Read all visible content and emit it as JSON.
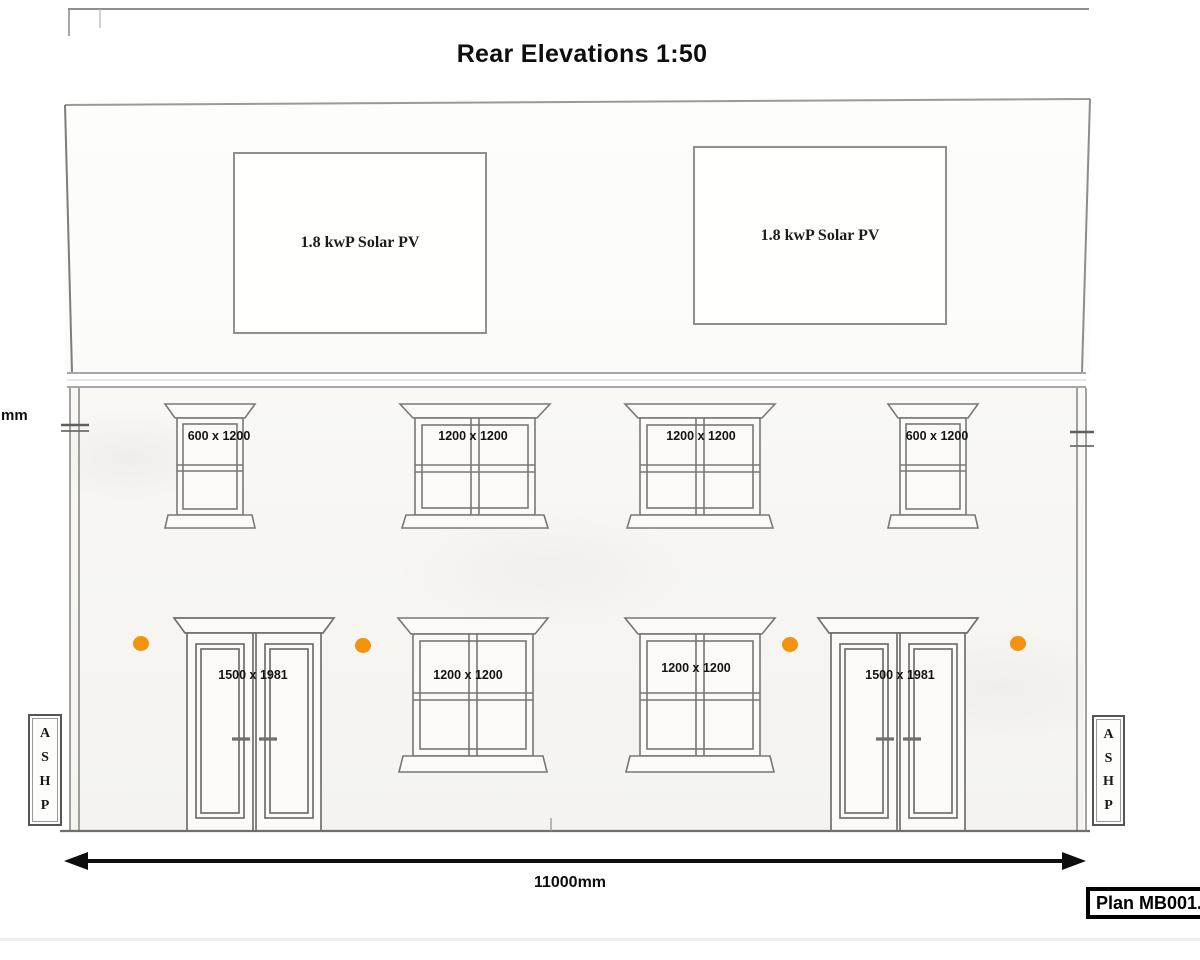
{
  "page": {
    "title": "Rear Elevations 1:50"
  },
  "roof": {
    "solar_panels": [
      {
        "label": "1.8 kwP Solar PV"
      },
      {
        "label": "1.8 kwP Solar PV"
      }
    ]
  },
  "upper_windows": [
    {
      "label": "600 x 1200"
    },
    {
      "label": "1200 x 1200"
    },
    {
      "label": "1200 x 1200"
    },
    {
      "label": "600 x 1200"
    }
  ],
  "ground_floor_openings": [
    {
      "type": "double_door",
      "label": "1500 x 1981"
    },
    {
      "type": "window",
      "label": "1200 x 1200"
    },
    {
      "type": "window",
      "label": "1200 x 1200"
    },
    {
      "type": "double_door",
      "label": "1500 x 1981"
    }
  ],
  "ashp_left": {
    "letters": [
      "A",
      "S",
      "H",
      "P"
    ]
  },
  "ashp_right": {
    "letters": [
      "A",
      "S",
      "H",
      "P"
    ]
  },
  "dimensions": {
    "overall_width": "11000mm",
    "left_edge_partial": "mm"
  },
  "plan_ref": {
    "label": "Plan MB001."
  },
  "colors": {
    "vent_dot": "#F5920D",
    "pencil": "#8b8b8b",
    "ink": "#0d0d0d"
  }
}
